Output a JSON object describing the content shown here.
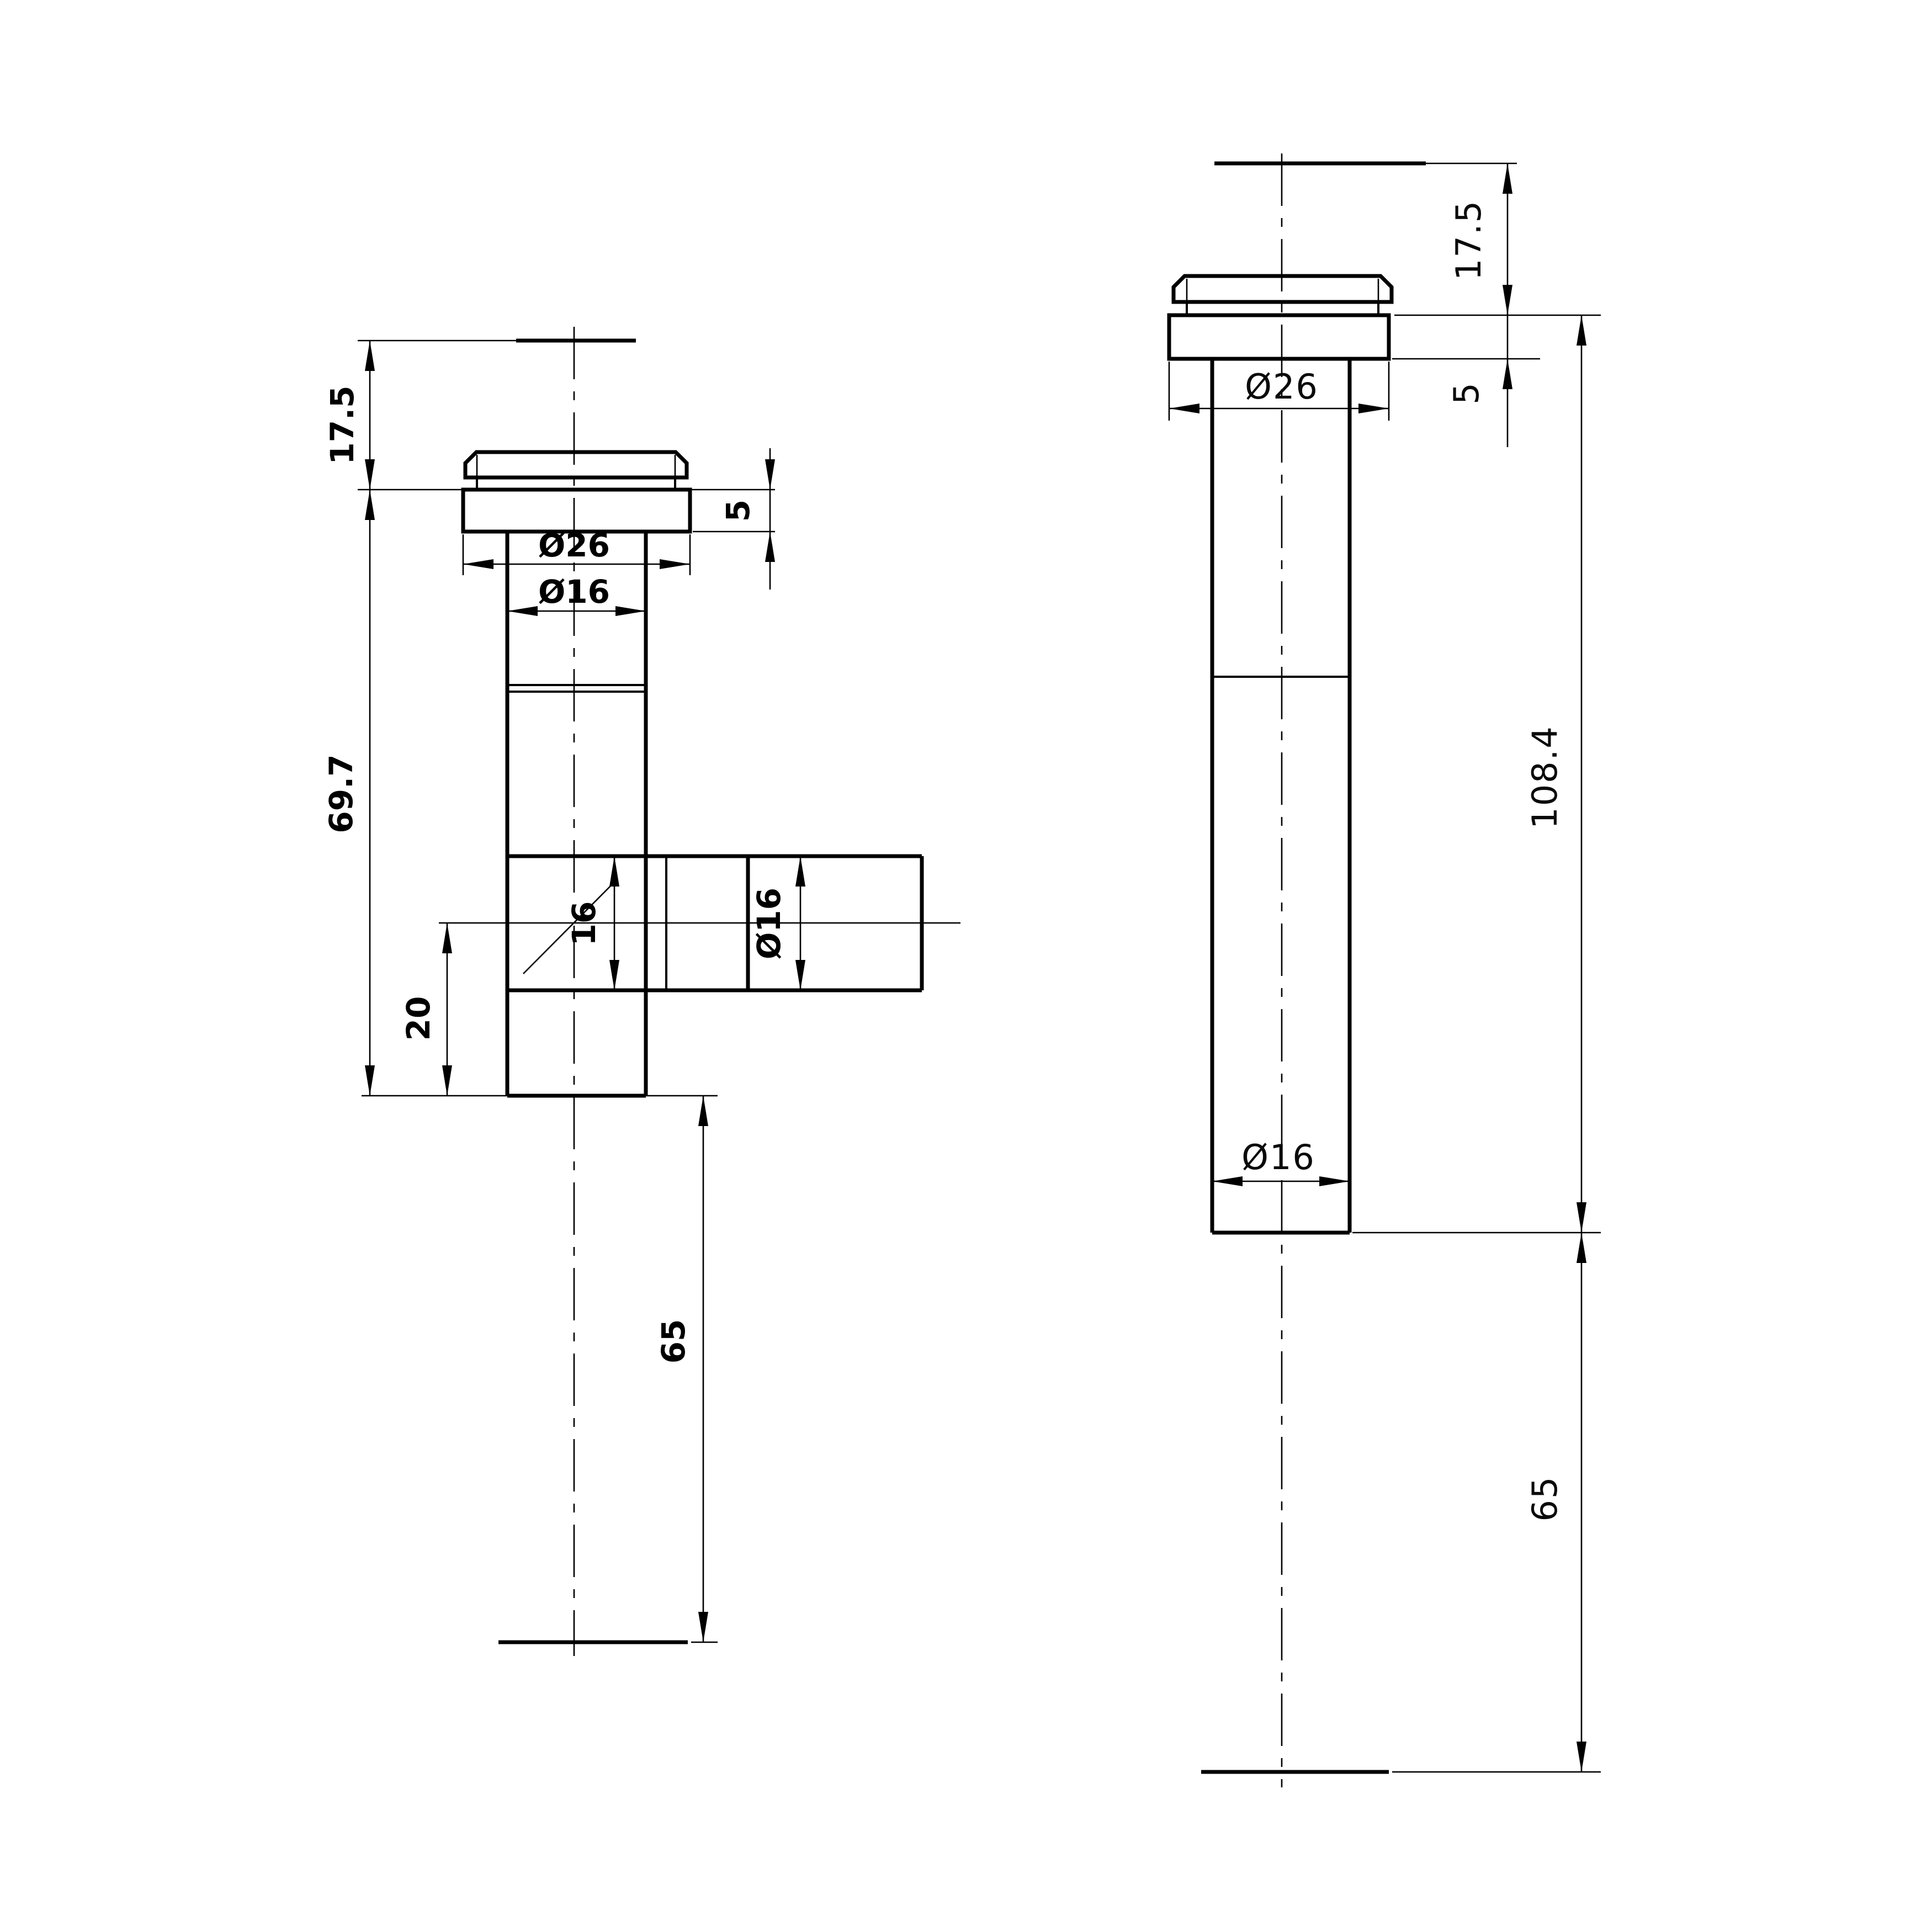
{
  "meta": {
    "drawing_type": "technical dimension drawing, two orthographic views of a drain pipe fitting",
    "background_color": "#ffffff",
    "line_color": "#000000"
  },
  "front_view": {
    "labels": {
      "top_height": "17.5",
      "body_height": "69.7",
      "flange_thickness": "5",
      "flange_diameter": "Ø26",
      "tube_diameter": "Ø16",
      "outlet_bore": "16",
      "outlet_diameter": "Ø16",
      "outlet_offset": "20",
      "tail_length": "65"
    }
  },
  "side_view": {
    "labels": {
      "top_height": "17.5",
      "flange_thickness": "5",
      "flange_diameter": "Ø26",
      "overall_length": "108.4",
      "tube_diameter": "Ø16",
      "tail_length": "65"
    }
  }
}
